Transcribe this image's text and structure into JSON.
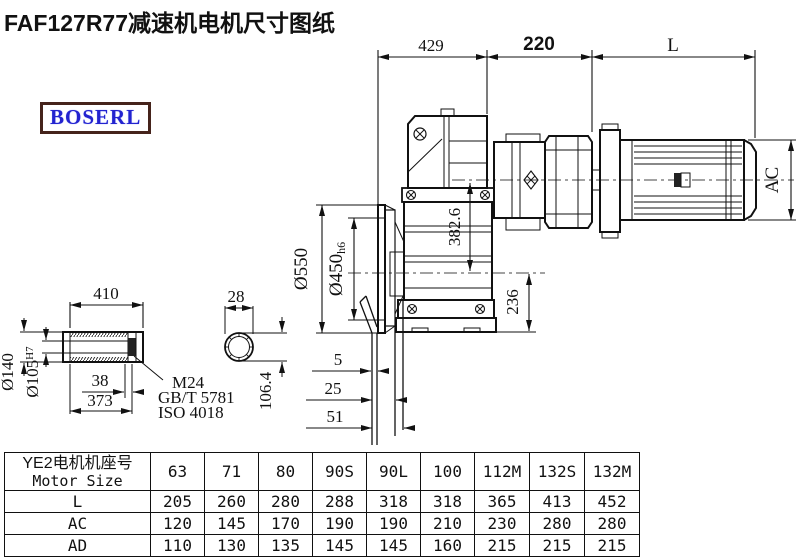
{
  "title": "FAF127R77减速机电机尺寸图纸",
  "logo": {
    "text": "BOSERL"
  },
  "colors": {
    "line": "#1c1c1c",
    "logo_text": "#2323cf",
    "logo_border": "#45231b",
    "background": "#ffffff"
  },
  "drawing": {
    "dims": {
      "top_429": "429",
      "top_220": "220",
      "top_L": "L",
      "motor_AC": "AC",
      "flange_od": "Ø550",
      "flange_spigot": "Ø450",
      "flange_spigot_tol": "h6",
      "height_382_6": "382.6",
      "height_236": "236",
      "offset_5": "5",
      "offset_25": "25",
      "offset_51": "51"
    },
    "shaft_detail": {
      "len_410": "410",
      "len_38": "38",
      "len_373": "373",
      "dia_140": "Ø140",
      "dia_105": "Ø105",
      "dia_105_tol": "H7",
      "thread": "M24",
      "std_gb": "GB/T 5781",
      "std_iso": "ISO 4018",
      "width_28": "28",
      "across_106_4": "106.4"
    }
  },
  "table": {
    "header_cn": "YE2电机机座号",
    "header_en": "Motor Size",
    "columns": [
      "63",
      "71",
      "80",
      "90S",
      "90L",
      "100",
      "112M",
      "132S",
      "132M"
    ],
    "rows": [
      {
        "label": "L",
        "values": [
          "205",
          "260",
          "280",
          "288",
          "318",
          "318",
          "365",
          "413",
          "452"
        ]
      },
      {
        "label": "AC",
        "values": [
          "120",
          "145",
          "170",
          "190",
          "190",
          "210",
          "230",
          "280",
          "280"
        ]
      },
      {
        "label": "AD",
        "values": [
          "110",
          "130",
          "135",
          "145",
          "145",
          "160",
          "215",
          "215",
          "215"
        ]
      }
    ]
  }
}
